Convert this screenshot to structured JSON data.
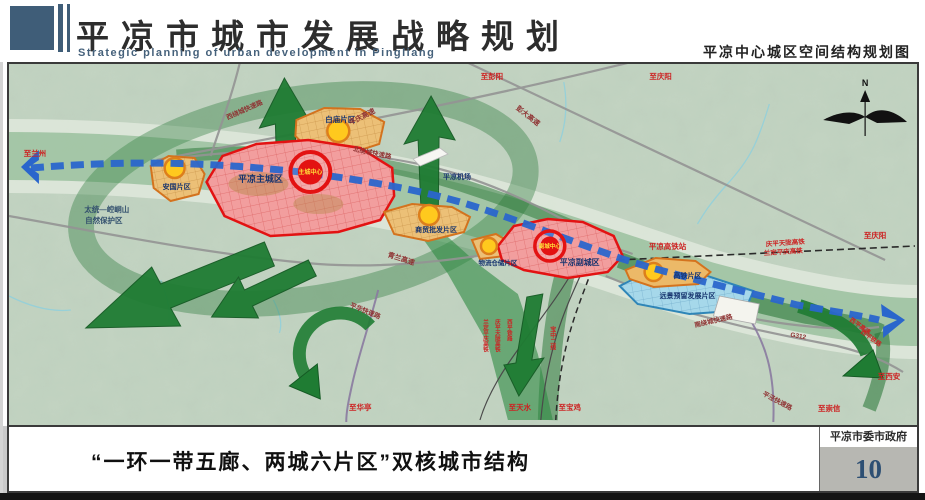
{
  "header": {
    "title": "平凉市城市发展战略规划",
    "subtitle": "Strategic planning of urban development in Pingliang",
    "map_title": "平凉中心城区空间结构规划图"
  },
  "footer": {
    "caption": "“一环一带五廊、两城六片区”双核城市结构",
    "credit": "平凉市委市政府",
    "page_number": "10"
  },
  "map": {
    "compass_n": "N",
    "zones": {
      "main_city": "平凉主城区",
      "main_center": "主城中心",
      "sub_city": "平凉副城区",
      "sub_center": "副城中心",
      "anguo": "安国片区",
      "baimiao": "白庙片区",
      "shangmao": "商贸批发片区",
      "wuliu": "物流仓储片区",
      "gaotie": "高铁片区",
      "yuanjing": "远景预留发展片区"
    },
    "sites": {
      "airport": "平凉机场",
      "hsr_station": "平凉高铁站",
      "reserve_line1": "太统—崆峒山",
      "reserve_line2": "自然保护区"
    },
    "roads": {
      "pingqing": "平庆高速",
      "pengda": "彭大高速",
      "qinglan": "青兰高速",
      "west_ring": "西绕城快速路",
      "north_ring": "北绕城快速路",
      "south_ring": "南绕城快速路",
      "g312": "G312",
      "pinghua": "平华快速路",
      "pingjing": "平泾快速路",
      "xiping_exp": "西平高速"
    },
    "railways": {
      "qptl": "庆平天陇高铁",
      "ldpq": "兰定平庆高铁",
      "qptl_v": "庆平天陇高铁",
      "ldpq_v": "兰定平庆高铁",
      "xiping_v": "西平铁路",
      "baozhong2": "宝中二线"
    },
    "directions": {
      "lanzhou": "至兰州",
      "pengyang": "至彭阳",
      "qingyang_top": "至庆阳",
      "qingyang_right": "至庆阳",
      "xian": "至西安",
      "chongxin": "至崇信",
      "huating": "至华亭",
      "tianshui": "至天水",
      "baoji": "至宝鸡"
    }
  },
  "colors": {
    "header_accent": "#3f5d78",
    "axis_blue": "#2a66cc",
    "corridor_green": "#1f7c33",
    "zone_red": "#e31212",
    "zone_orange": "#e8a33c",
    "zone_blue": "#a6d8ea",
    "label_red": "#cc2222",
    "page_number_blue": "#2d4f73"
  }
}
